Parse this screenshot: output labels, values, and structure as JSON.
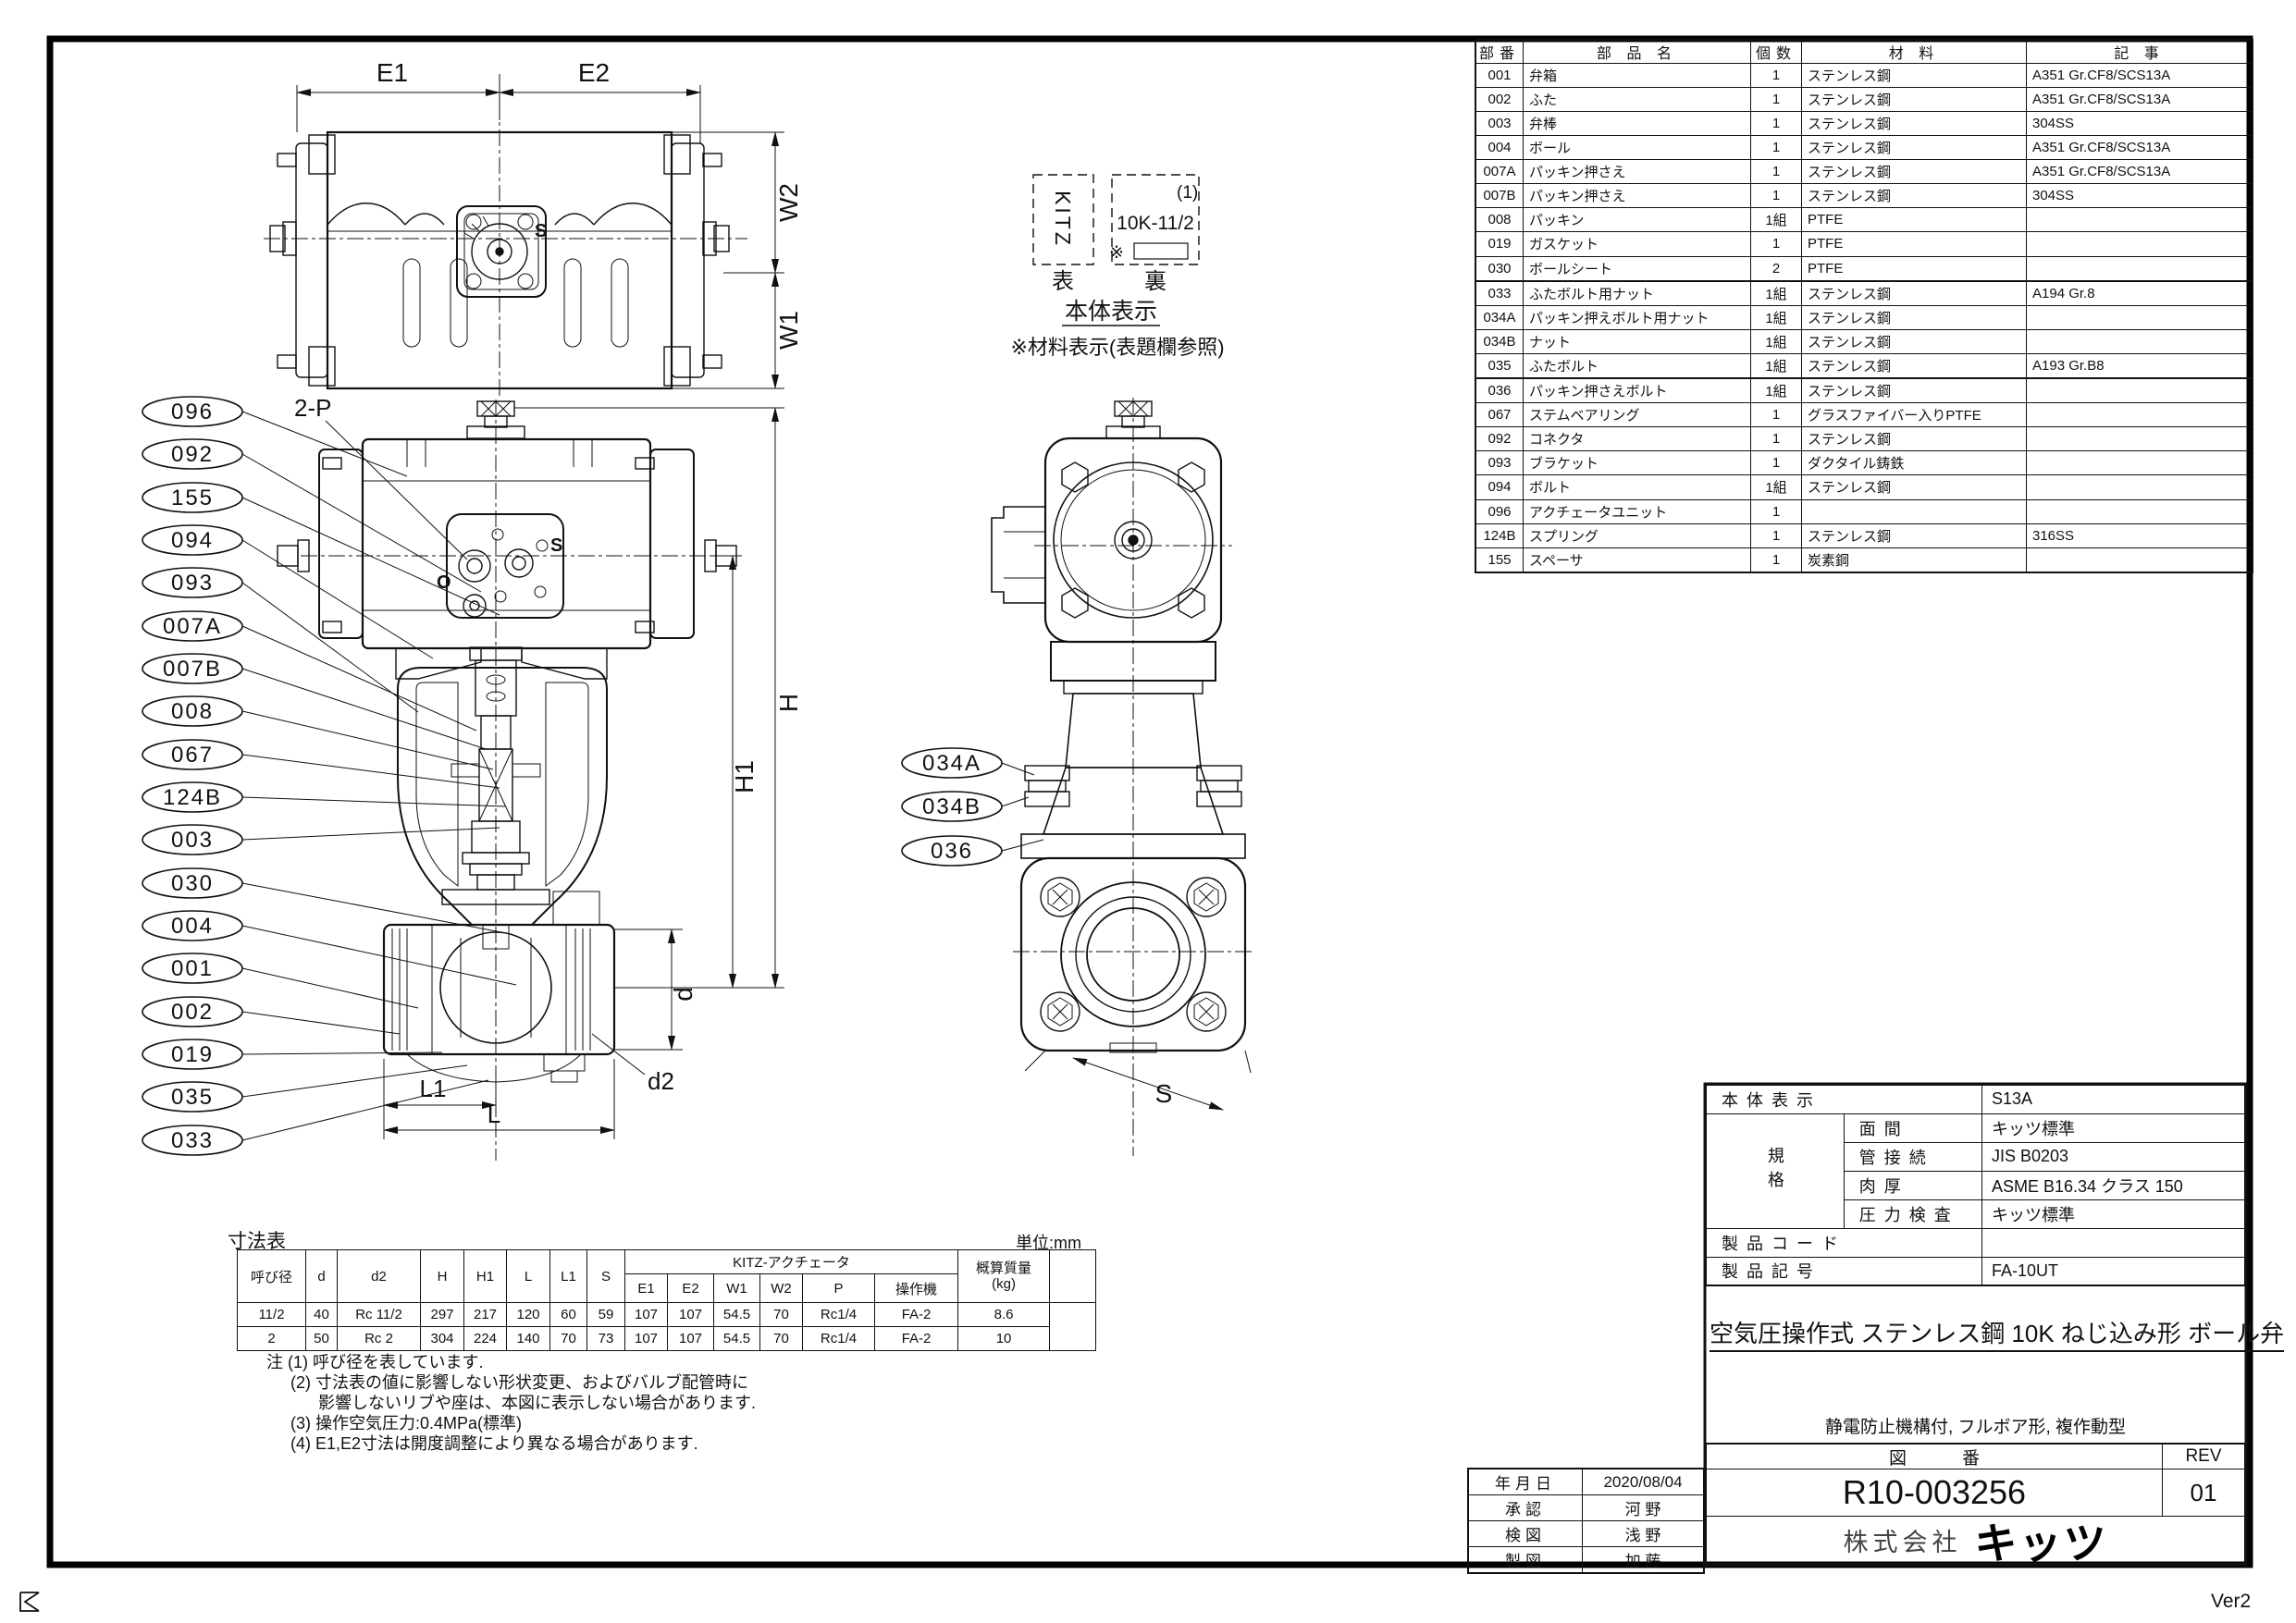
{
  "parts_table": {
    "headers": [
      "部番",
      "部 品 名",
      "個数",
      "材 料",
      "記 事"
    ],
    "rows": [
      [
        "001",
        "弁箱",
        "1",
        "ステンレス鋼",
        "A351 Gr.CF8/SCS13A"
      ],
      [
        "002",
        "ふた",
        "1",
        "ステンレス鋼",
        "A351 Gr.CF8/SCS13A"
      ],
      [
        "003",
        "弁棒",
        "1",
        "ステンレス鋼",
        "304SS"
      ],
      [
        "004",
        "ボール",
        "1",
        "ステンレス鋼",
        "A351 Gr.CF8/SCS13A"
      ],
      [
        "007A",
        "パッキン押さえ",
        "1",
        "ステンレス鋼",
        "A351 Gr.CF8/SCS13A"
      ],
      [
        "007B",
        "パッキン押さえ",
        "1",
        "ステンレス鋼",
        "304SS"
      ],
      [
        "008",
        "パッキン",
        "1組",
        "PTFE",
        ""
      ],
      [
        "019",
        "ガスケット",
        "1",
        "PTFE",
        ""
      ],
      [
        "030",
        "ボールシート",
        "2",
        "PTFE",
        ""
      ],
      [
        "033",
        "ふたボルト用ナット",
        "1組",
        "ステンレス鋼",
        "A194 Gr.8"
      ],
      [
        "034A",
        "パッキン押えボルト用ナット",
        "1組",
        "ステンレス鋼",
        ""
      ],
      [
        "034B",
        "ナット",
        "1組",
        "ステンレス鋼",
        ""
      ],
      [
        "035",
        "ふたボルト",
        "1組",
        "ステンレス鋼",
        "A193 Gr.B8"
      ],
      [
        "036",
        "パッキン押さえボルト",
        "1組",
        "ステンレス鋼",
        ""
      ],
      [
        "067",
        "ステムベアリング",
        "1",
        "グラスファイバー入りPTFE",
        ""
      ],
      [
        "092",
        "コネクタ",
        "1",
        "ステンレス鋼",
        ""
      ],
      [
        "093",
        "ブラケット",
        "1",
        "ダクタイル鋳鉄",
        ""
      ],
      [
        "094",
        "ボルト",
        "1組",
        "ステンレス鋼",
        ""
      ],
      [
        "096",
        "アクチェータユニット",
        "1",
        "",
        ""
      ],
      [
        "124B",
        "スプリング",
        "1",
        "ステンレス鋼",
        "316SS"
      ],
      [
        "155",
        "スペーサ",
        "1",
        "炭素鋼",
        ""
      ]
    ]
  },
  "nameplate": {
    "front_text": "KITZ",
    "front_caption": "表",
    "back_caption": "裏",
    "back_line1": "(1)",
    "back_line2": "10K-11/2",
    "back_star": "※",
    "heading": "本体表示",
    "note": "※材料表示(表題欄参照)"
  },
  "balloons": {
    "left": [
      "096",
      "092",
      "155",
      "094",
      "093",
      "007A",
      "007B",
      "008",
      "067",
      "124B",
      "003",
      "030",
      "004",
      "001",
      "002",
      "019",
      "035",
      "033"
    ],
    "right": [
      "034A",
      "034B",
      "036"
    ]
  },
  "dims": {
    "E1": "E1",
    "E2": "E2",
    "W1": "W1",
    "W2": "W2",
    "H": "H",
    "H1": "H1",
    "d": "d",
    "d2": "d2",
    "L1": "L1",
    "L": "L",
    "S": "S",
    "twoP": "2-P"
  },
  "dim_table": {
    "title": "寸法表",
    "unit": "単位:mm",
    "actuator_span": "KITZ-アクチェータ",
    "mass_header": "概算質量",
    "mass_unit": "(kg)",
    "cols": [
      "呼び径",
      "d",
      "d2",
      "H",
      "H1",
      "L",
      "L1",
      "S",
      "E1",
      "E2",
      "W1",
      "W2",
      "P",
      "操作機"
    ],
    "rows": [
      [
        "11/2",
        "40",
        "Rc 11/2",
        "297",
        "217",
        "120",
        "60",
        "59",
        "107",
        "107",
        "54.5",
        "70",
        "Rc1/4",
        "FA-2",
        "8.6"
      ],
      [
        "2",
        "50",
        "Rc 2",
        "304",
        "224",
        "140",
        "70",
        "73",
        "107",
        "107",
        "54.5",
        "70",
        "Rc1/4",
        "FA-2",
        "10"
      ]
    ]
  },
  "notes": [
    "注 (1) 呼び径を表しています.",
    "(2) 寸法表の値に影響しない形状変更、およびバルブ配管時に",
    "影響しないリブや座は、本図に表示しない場合があります.",
    "(3) 操作空気圧力:0.4MPa(標準)",
    "(4) E1,E2寸法は開度調整により異なる場合があります."
  ],
  "spec_table": {
    "group": "規格",
    "rows": [
      [
        "本体表示",
        "S13A"
      ],
      [
        "面間",
        "キッツ標準"
      ],
      [
        "管接続",
        "JIS B0203"
      ],
      [
        "肉厚",
        "ASME B16.34 クラス 150"
      ],
      [
        "圧力検査",
        "キッツ標準"
      ],
      [
        "製品コード",
        ""
      ],
      [
        "製品記号",
        "FA-10UT"
      ]
    ]
  },
  "approval": {
    "rows": [
      [
        "年月日",
        "2020/08/04"
      ],
      [
        "承認",
        "河 野"
      ],
      [
        "検図",
        "浅 野"
      ],
      [
        "製図",
        "加 藤"
      ]
    ]
  },
  "title_block": {
    "title": "空気圧操作式 ステンレス鋼 10K ねじ込み形 ボール弁",
    "subtitle": "静電防止機構付, フルボア形, 複作動型",
    "zuban_label": "図番",
    "rev_label": "REV",
    "drawing_no": "R10-003256",
    "rev": "01",
    "company_prefix": "株式会社",
    "company_logo": "キッツ",
    "version": "Ver2"
  }
}
